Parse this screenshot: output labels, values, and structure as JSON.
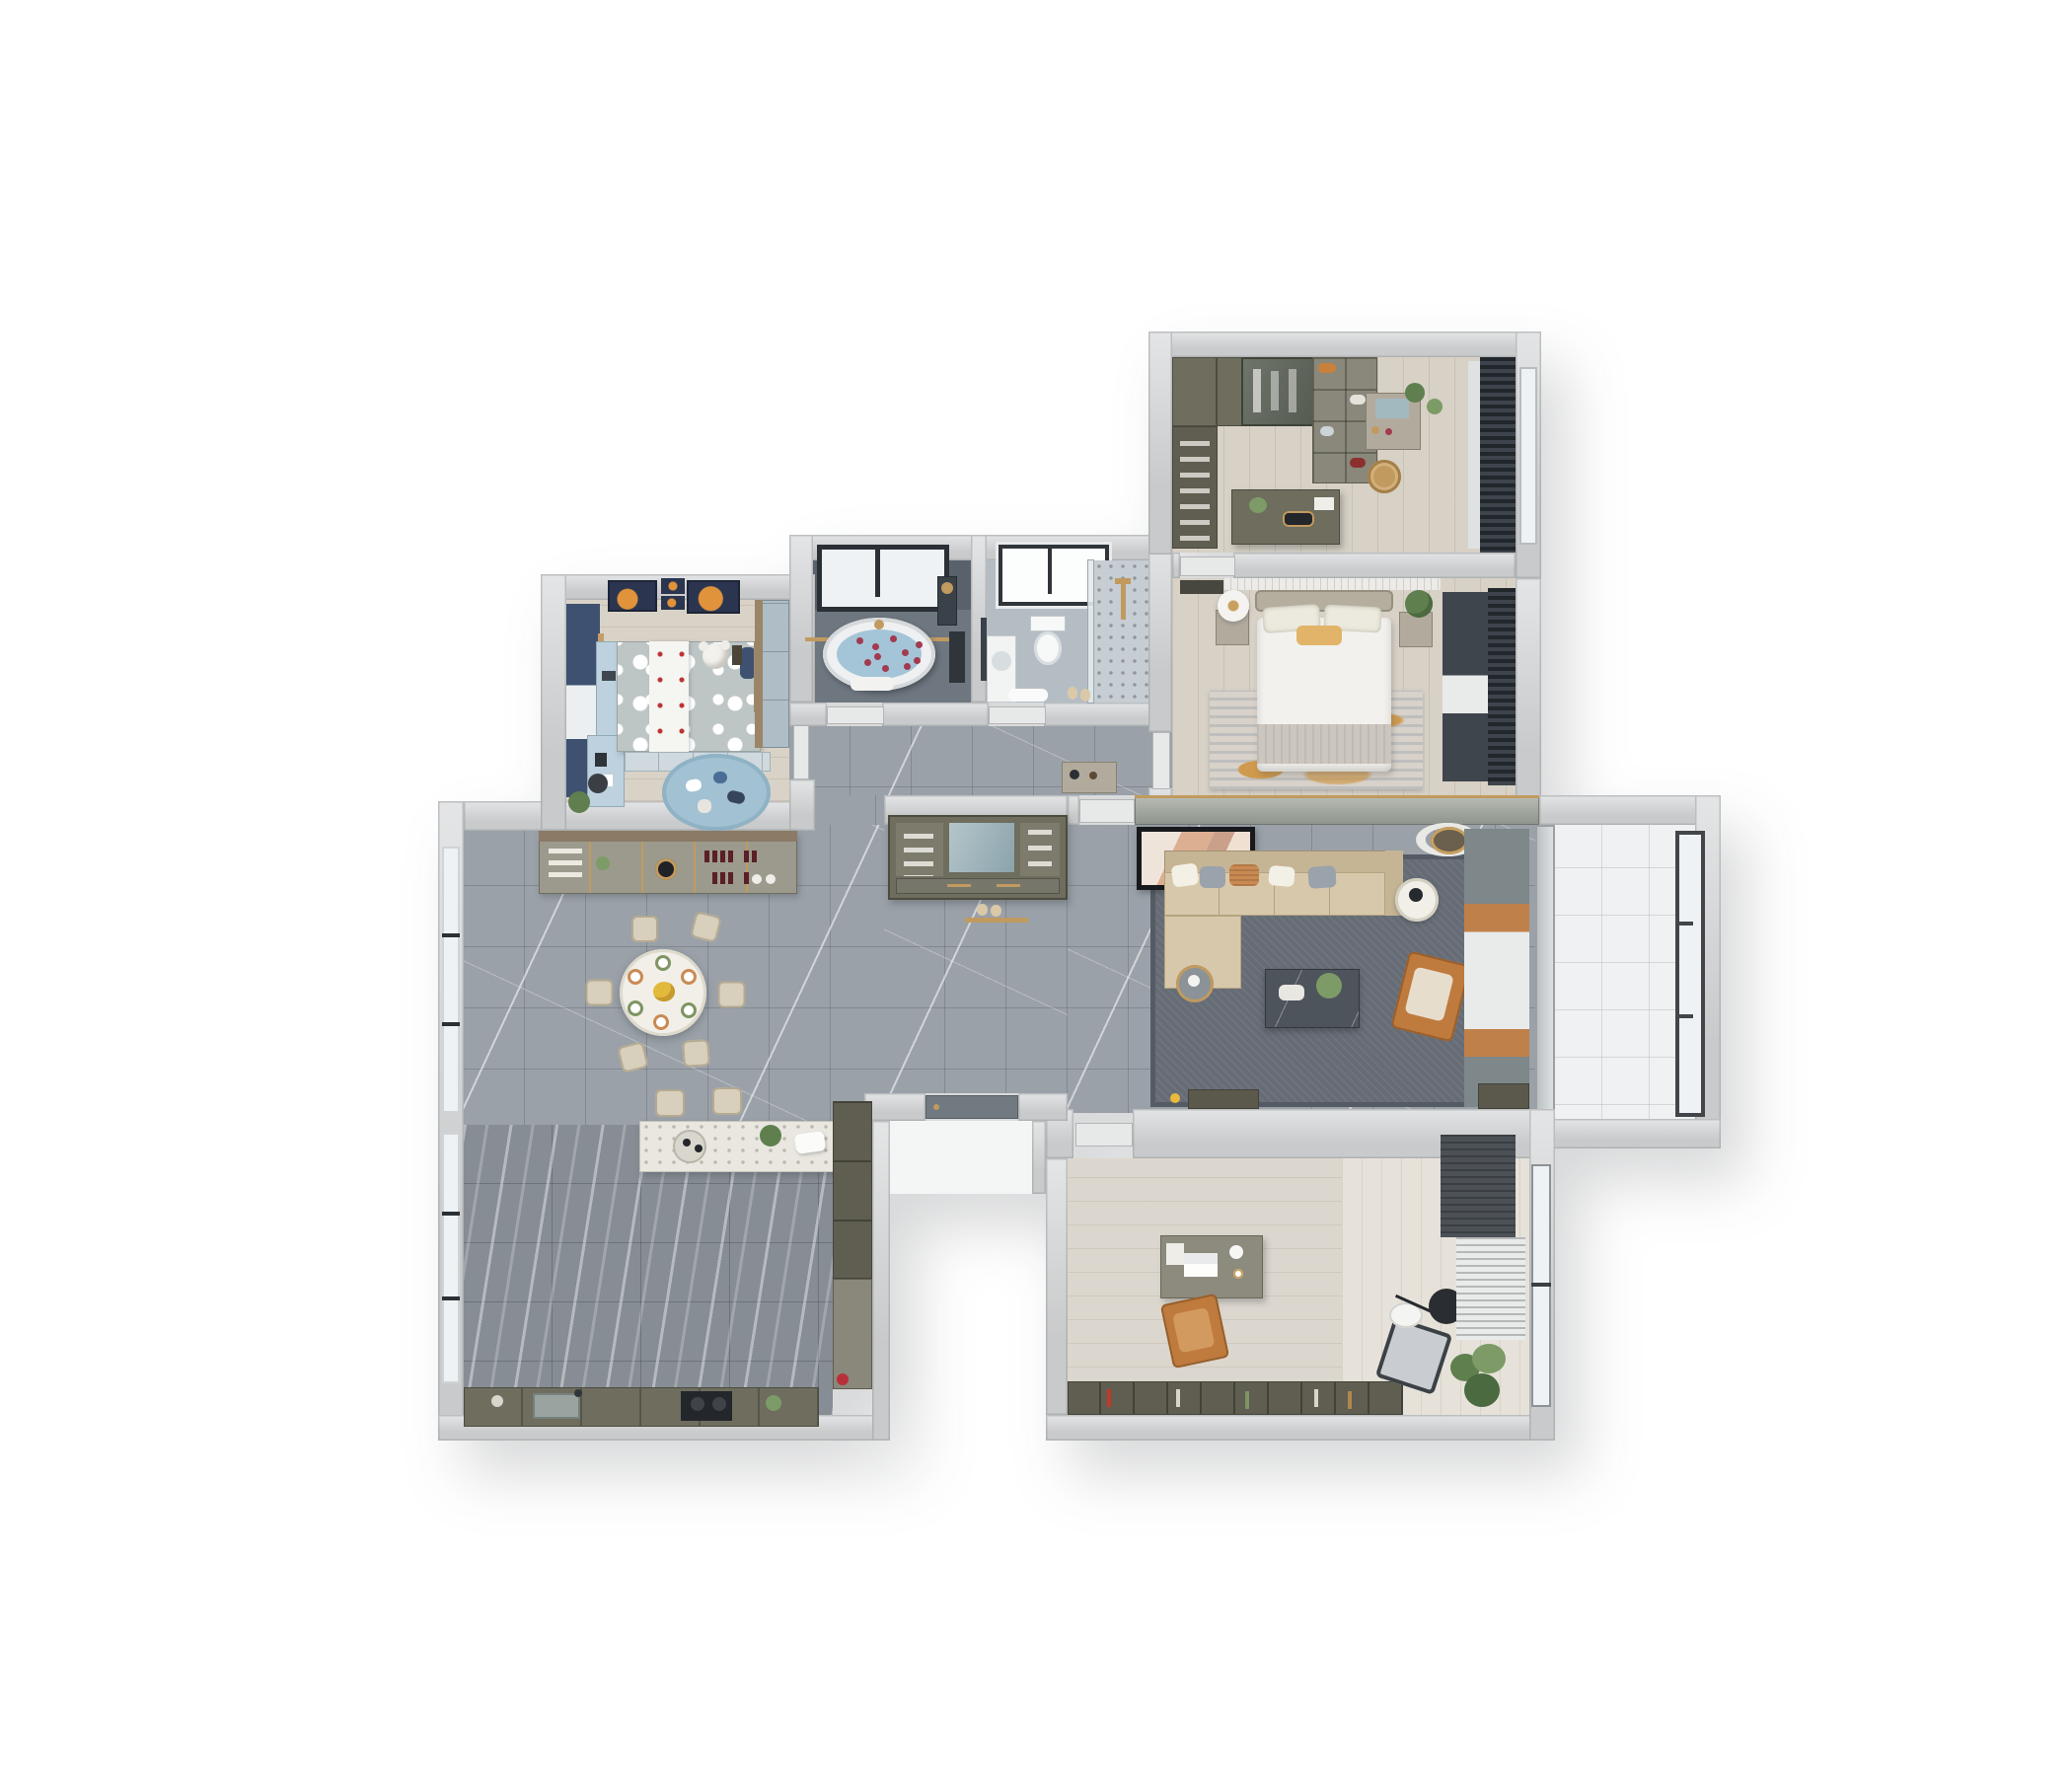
{
  "scene": {
    "type": "3D rendered apartment floor plan, top-down view on white background",
    "rooms": [
      {
        "id": "walk-in-closet",
        "label": "Walk-in closet / dressing room",
        "floor": "light wood",
        "furniture": [
          "wardrobe-run",
          "glass-wardrobe",
          "shelf-unit",
          "vanity-with-mirror",
          "rattan-basket",
          "closet-island-desk",
          "window-blinds"
        ]
      },
      {
        "id": "master-bedroom",
        "label": "Master bedroom",
        "floor": "light wood",
        "furniture": [
          "double-bed",
          "nightstand-left-with-lamp",
          "nightstand-right-with-plant",
          "area-rug-orange-grey",
          "dark-curtains",
          "dresser"
        ]
      },
      {
        "id": "bathroom-tub",
        "label": "Bathroom with oval tub",
        "floor": "dark grey tile",
        "furniture": [
          "oval-bathtub-with-petals",
          "black-frame-window",
          "gold-towel-rail",
          "shower-column",
          "towel"
        ]
      },
      {
        "id": "bathroom-shower",
        "label": "Bathroom with shower and toilet",
        "floor": "light grey tile",
        "furniture": [
          "toilet",
          "vanity-sink",
          "mirror",
          "walk-in-shower",
          "window",
          "slippers",
          "bath-mat"
        ]
      },
      {
        "id": "kids-room",
        "label": "Kids bedroom",
        "floor": "light wood",
        "furniture": [
          "polka-dot-bed",
          "teddy-bear",
          "blue-curtains",
          "desk-cabinet",
          "wardrobe",
          "round-play-rug",
          "four-wall-frames"
        ]
      },
      {
        "id": "dining-room",
        "label": "Dining room",
        "floor": "grey marble tile",
        "furniture": [
          "round-dining-table",
          "six-dining-chairs",
          "buffet-wine-cabinet",
          "glass-sliding-door"
        ]
      },
      {
        "id": "kitchen",
        "label": "Open kitchen",
        "floor": "dark striped marble",
        "furniture": [
          "island-bar",
          "two-bar-stools",
          "sink-counter",
          "cooktop",
          "tall-cabinets",
          "window"
        ]
      },
      {
        "id": "entry-hall",
        "label": "Entry hall",
        "floor": "grey marble tile",
        "furniture": [
          "shoe-cabinet-with-mirror",
          "front-door",
          "gold-floor-inlay"
        ]
      },
      {
        "id": "living-room",
        "label": "Living room",
        "floor": "grey marble + dark rug",
        "furniture": [
          "l-shaped-sofa",
          "five-pillows",
          "coffee-table",
          "orange-armchair",
          "round-side-tables",
          "leaning-artwork",
          "ceiling-ring-lamp",
          "curtains-green-orange-sheer",
          "media-ledges"
        ]
      },
      {
        "id": "balcony-living",
        "label": "Living room balcony",
        "floor": "white tile",
        "furniture": [
          "three-pane-window"
        ]
      },
      {
        "id": "study",
        "label": "Study / home office",
        "floor": "light wood",
        "furniture": [
          "desk-with-laptop",
          "leather-office-chair",
          "low-bookcase",
          "lounge-chair",
          "arc-floor-lamp",
          "potted-plant",
          "curtains",
          "window"
        ]
      }
    ],
    "counts": {
      "dining_chairs": 6,
      "bar_stools": 2,
      "kids_wall_frames": 4,
      "balcony_window_panes": 3,
      "sofa_pillows": 5,
      "tub_petals": 10,
      "hall_doors": 2
    }
  },
  "palette": {
    "wall": "#c9cacb",
    "wallhi": "#e4e5e6",
    "walledge": "#9fa2a4",
    "panel": "#8e948c",
    "gold": "#c19a5f",
    "marble": "#9aa1a8",
    "kitchenfloor": "#868d94",
    "wood": "#d7d1c6",
    "woodstudy": "#dcd7ce",
    "woodnook": "#e6e2da",
    "kidsfloor": "#d9d2c7",
    "ruglive": "#666c75",
    "rugliveedge": "#555b64",
    "rugmaster": "#d8d2ca",
    "rugorange": "#cf9a4d",
    "ruggray": "#a0a7ae",
    "sofa": "#d8c8ab",
    "sofadark": "#c6b595",
    "cream": "#f1efe8",
    "white": "#f7f7f5",
    "orangechair": "#bf7a3d",
    "darktable": "#4e545b",
    "beige": "#d8cfbc",
    "bedwhite": "#f2f1ee",
    "blanket": "#cbc6be",
    "accent": "#e2b469",
    "headboard": "#b5ae9f",
    "night": "#b2ab9d",
    "olive": "#6e6d5e",
    "olivedark": "#5f5e50",
    "olivelight": "#8a887a",
    "buffet": "#9c9a8c",
    "buffetwood": "#8a7a66",
    "kidsblue": "#5b7191",
    "kidsnavy": "#3e5170",
    "kidsduvet": "#bdc5c5",
    "kidsrug": "#a2c1d2",
    "kidsdesk": "#bdd2de",
    "kidswardrobe": "#aebdc6",
    "framenavy": "#2b3550",
    "frameorange": "#e0933b",
    "bathwall": "#59616a",
    "bathfloor": "#6e7780",
    "water": "#a4c5d7",
    "petal": "#a23a50",
    "bathbfloor": "#b5bdc4",
    "showerfloor": "#c6cdd3",
    "glass": "#eef2f4",
    "framedark": "#2b3036",
    "curtgreen": "#7e8789",
    "curtorange": "#c08049",
    "sheer": "#e9ebeb",
    "blinddark": "#2c3136",
    "curtnavy": "#3f454d",
    "balconyfloor": "#eff1f2",
    "terrazzo": "#e9e7e0",
    "steel": "#9aa39f",
    "cooktop": "#23262b",
    "plant": "#5f7f4f",
    "plantlight": "#7d9b66",
    "doorleaf": "#e7e8e8",
    "doorslate": "#717a80",
    "mirror": "#a3b9c0",
    "porch": "#f4f5f5"
  }
}
